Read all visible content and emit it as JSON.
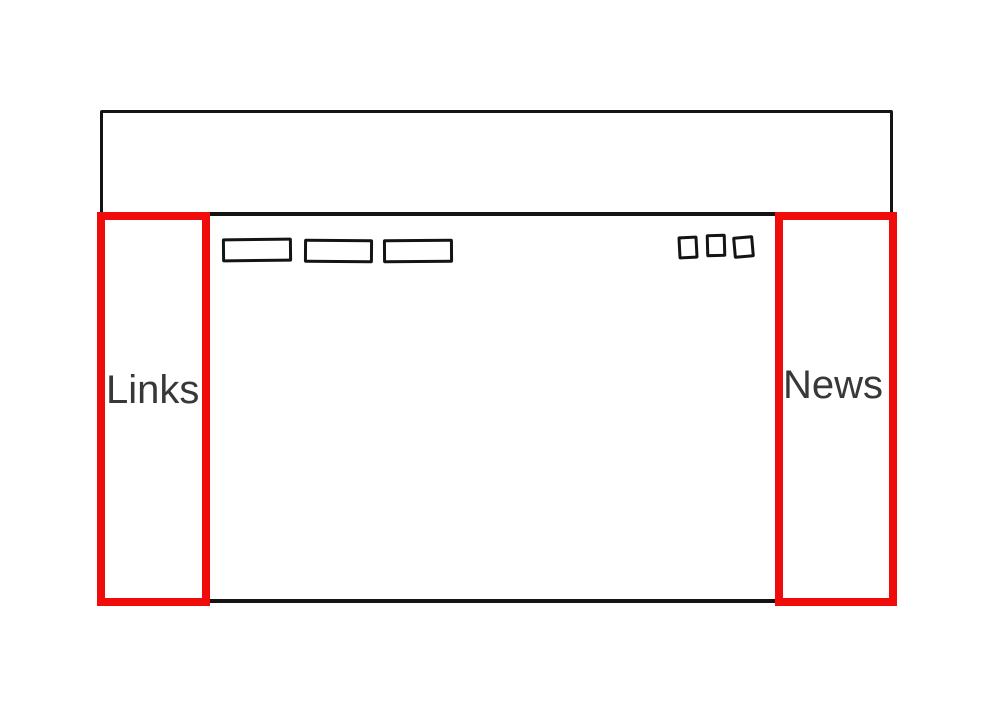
{
  "wireframe": {
    "description": "Hand-drawn website layout wireframe",
    "header": {
      "name": "header-area"
    },
    "sidebar_left": {
      "label": "Links"
    },
    "sidebar_right": {
      "label": "News"
    },
    "nav_buttons": [
      {
        "name": "nav-button-placeholder-1",
        "label": ""
      },
      {
        "name": "nav-button-placeholder-2",
        "label": ""
      },
      {
        "name": "nav-button-placeholder-3",
        "label": ""
      }
    ],
    "window_controls": [
      {
        "name": "square-placeholder-1",
        "label": ""
      },
      {
        "name": "square-placeholder-2",
        "label": ""
      },
      {
        "name": "square-placeholder-3",
        "label": ""
      }
    ]
  },
  "colors": {
    "highlight_red": "#f10c0c",
    "sketch_black": "#141414",
    "label_text": "#383838",
    "background": "#ffffff"
  }
}
